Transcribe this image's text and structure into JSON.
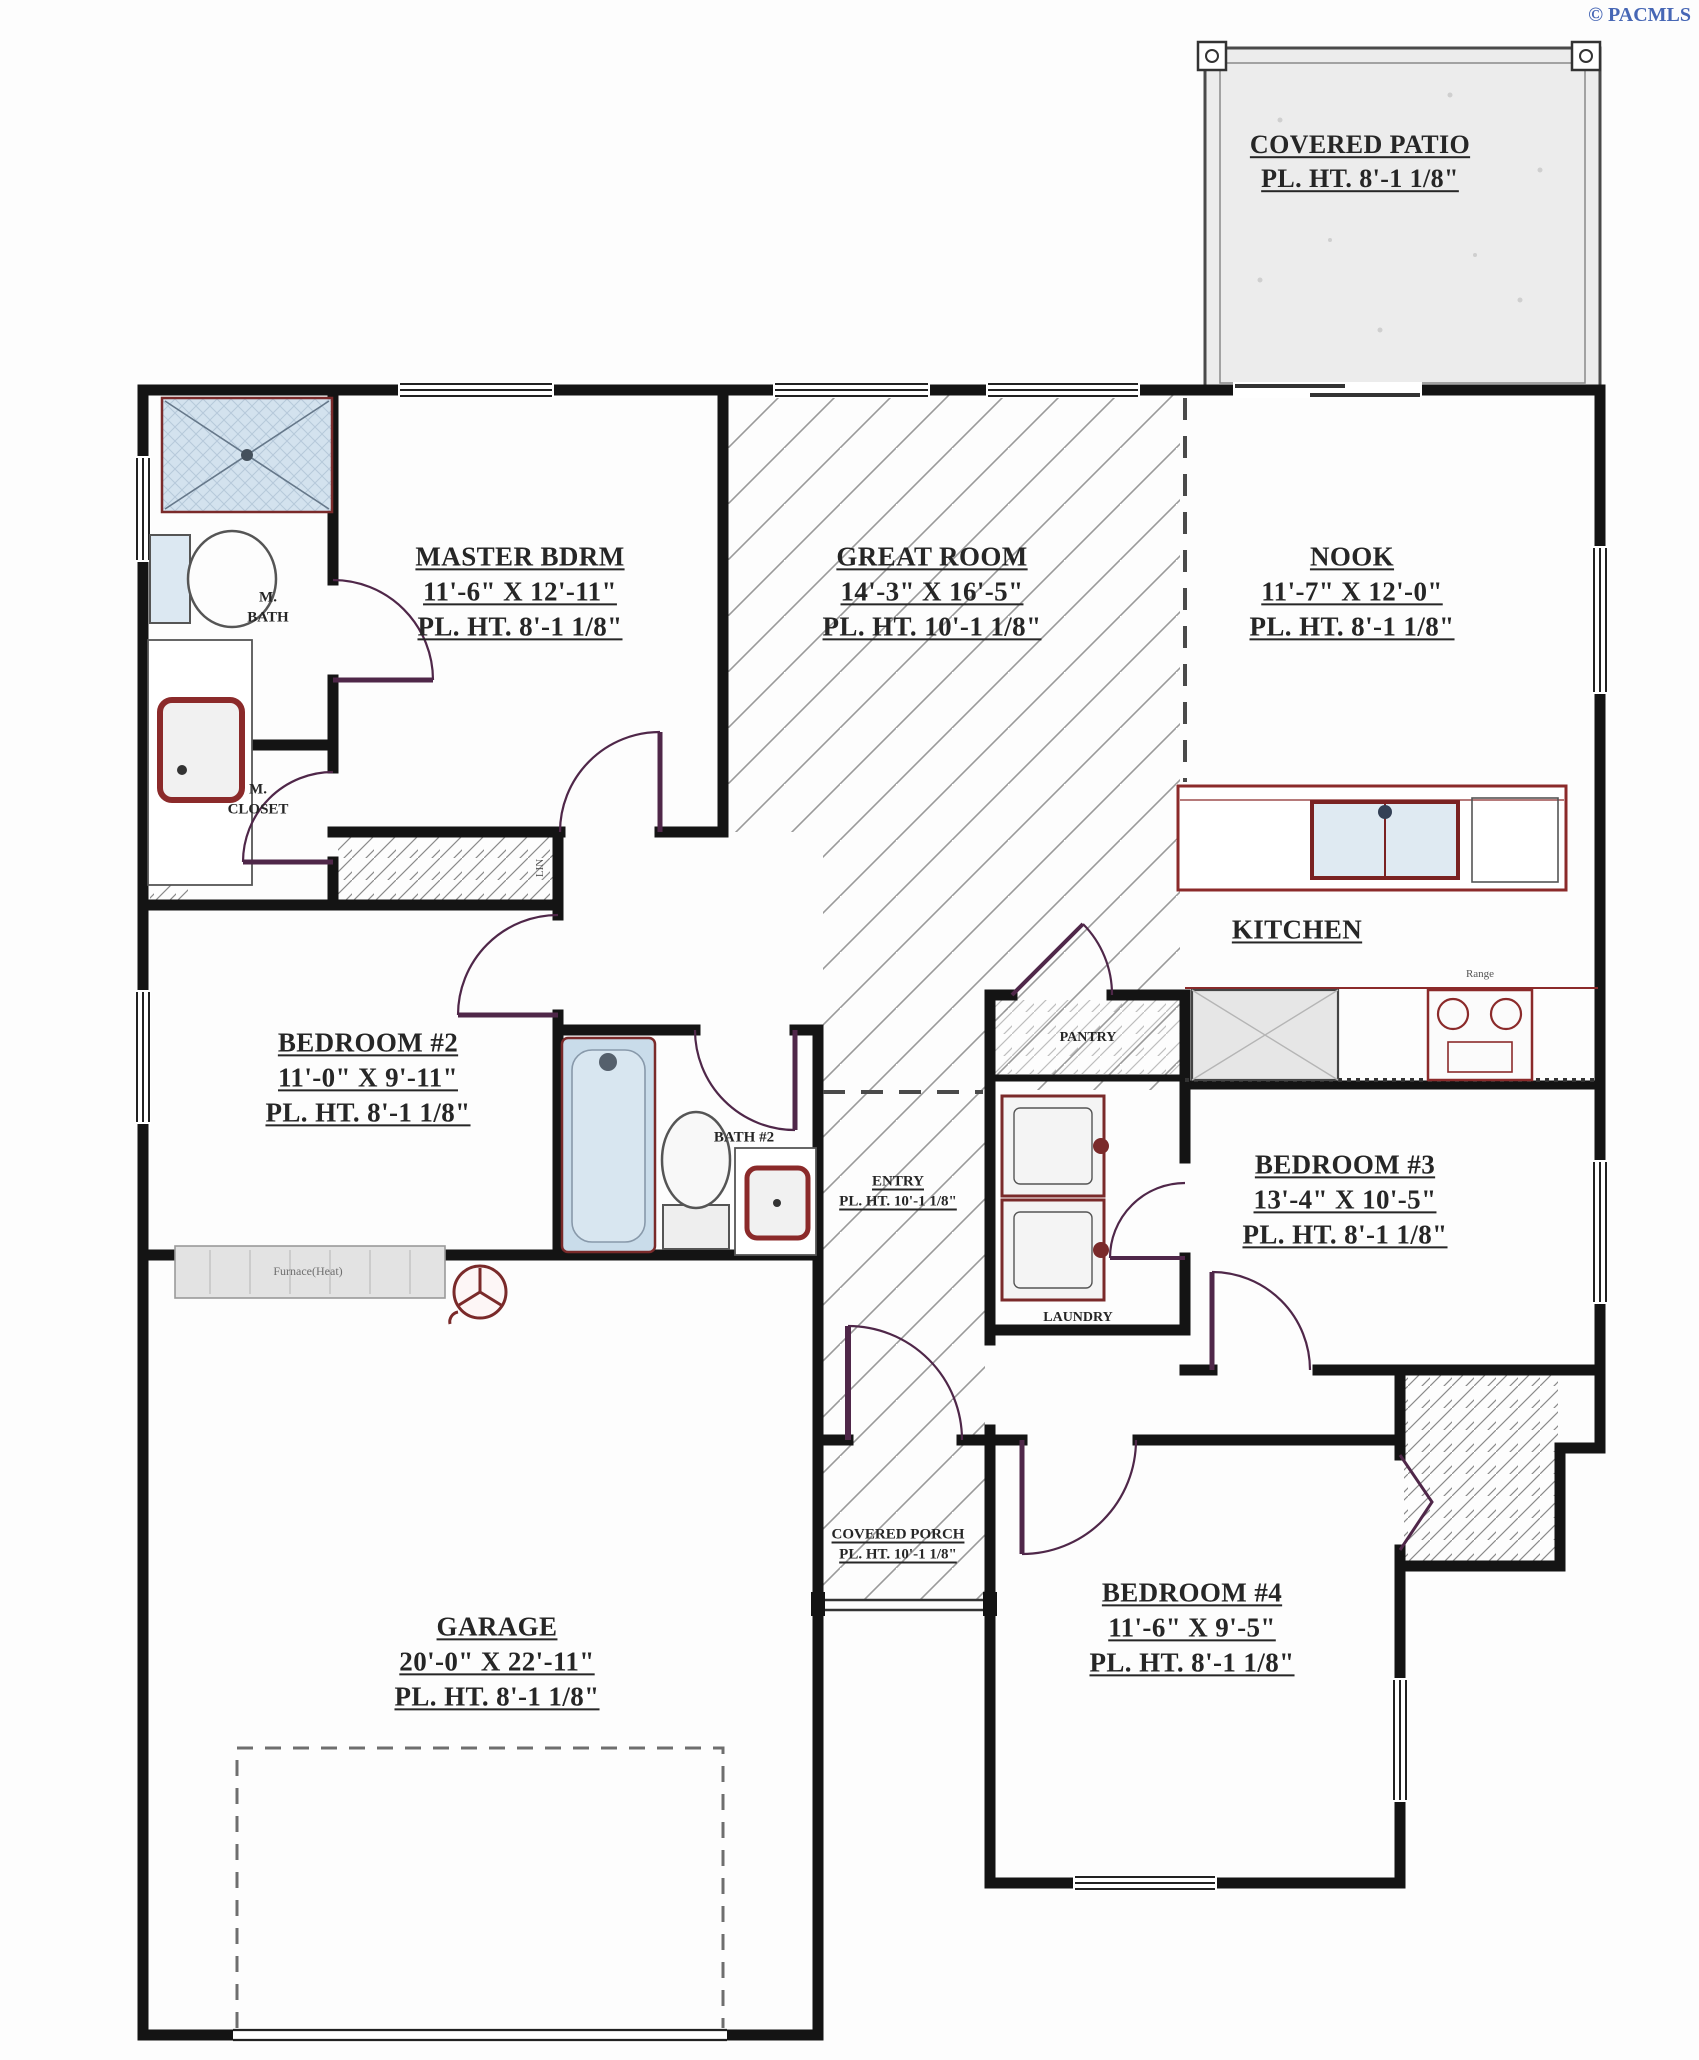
{
  "copyright": "© PACMLS",
  "rooms": {
    "covered_patio": {
      "name": "COVERED PATIO",
      "height": "PL. HT. 8'-1 1/8\""
    },
    "master": {
      "name": "MASTER BDRM",
      "size": "11'-6\" X 12'-11\"",
      "height": "PL. HT. 8'-1 1/8\""
    },
    "great_room": {
      "name": "GREAT ROOM",
      "size": "14'-3\" X 16'-5\"",
      "height": "PL. HT. 10'-1 1/8\""
    },
    "nook": {
      "name": "NOOK",
      "size": "11'-7\" X 12'-0\"",
      "height": "PL. HT. 8'-1 1/8\""
    },
    "kitchen": {
      "name": "KITCHEN"
    },
    "m_bath": {
      "line1": "M.",
      "line2": "BATH"
    },
    "m_closet": {
      "line1": "M.",
      "line2": "CLOSET"
    },
    "bedroom2": {
      "name": "BEDROOM #2",
      "size": "11'-0\" X 9'-11\"",
      "height": "PL. HT. 8'-1 1/8\""
    },
    "bath2": {
      "name": "BATH #2"
    },
    "pantry": {
      "name": "PANTRY"
    },
    "laundry": {
      "name": "LAUNDRY"
    },
    "entry": {
      "name": "ENTRY",
      "height": "PL. HT. 10'-1 1/8\""
    },
    "bedroom3": {
      "name": "BEDROOM #3",
      "size": "13'-4\" X 10'-5\"",
      "height": "PL. HT. 8'-1 1/8\""
    },
    "covered_porch": {
      "name": "COVERED PORCH",
      "height": "PL. HT. 10'-1 1/8\""
    },
    "bedroom4": {
      "name": "BEDROOM #4",
      "size": "11'-6\" X 9'-5\"",
      "height": "PL. HT. 8'-1 1/8\""
    },
    "garage": {
      "name": "GARAGE",
      "size": "20'-0\" X 22'-11\"",
      "height": "PL. HT. 8'-1 1/8\""
    }
  },
  "fixtures": {
    "furnace": "Furnace(Heat)",
    "range": "Range",
    "linen": "LIN"
  },
  "colors": {
    "wall": "#141414",
    "door": "#4f2749",
    "fixture": "#7a2a2a",
    "tub_fill": "#c9dcea",
    "hatch": "#9a9a9a",
    "copyright": "#4767b5"
  }
}
